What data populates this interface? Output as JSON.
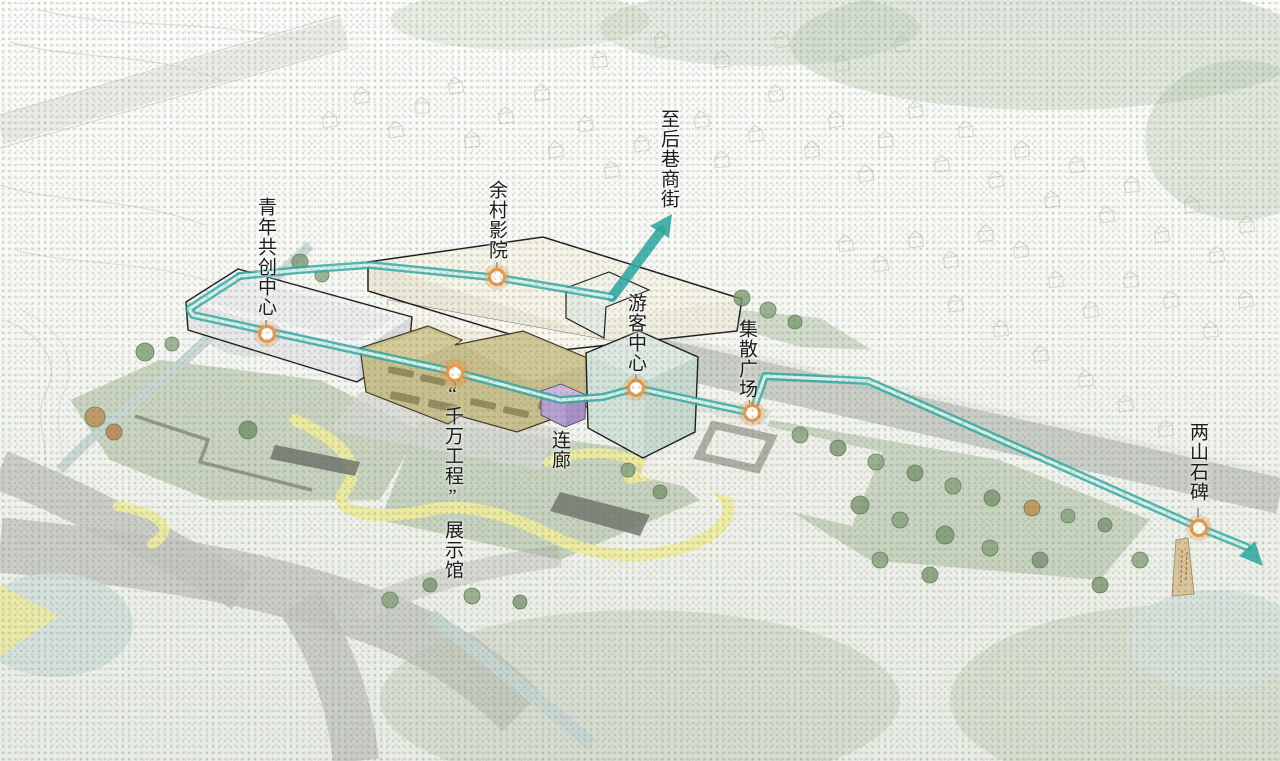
{
  "page": {
    "kind": "architectural-site-plan",
    "view": "isometric masterplan with guided tour route"
  },
  "labels": {
    "youth_center": "青年共创中心",
    "cinema": "余村影院",
    "to_back_street": "至后巷商街",
    "visitor_center": "游客中心",
    "plaza": "集散广场",
    "corridor": "连廊",
    "exhibition_quote": "“千万工程”",
    "exhibition_name": "展示馆",
    "stone_monument": "两山石碑"
  },
  "route": {
    "waypoints": [
      "青年共创中心",
      "余村影院",
      "“千万工程”展示馆",
      "游客中心",
      "集散广场",
      "两山石碑"
    ],
    "arrow_destination": "至后巷商街"
  },
  "colors": {
    "route_teal": "#2EA8A3",
    "route_inner": "#DCF2EE",
    "marker_ring": "#E39A52",
    "cinema_building": "#F6F3E8",
    "youth_center_building": "#F4F4F6",
    "exhibition_building": "#C9BF8E",
    "visitor_center_building": "#DDE9E2",
    "corridor_purple": "#B7A0D2",
    "path_yellow": "#EFEB9F",
    "road_gray": "#C3C5C0"
  }
}
